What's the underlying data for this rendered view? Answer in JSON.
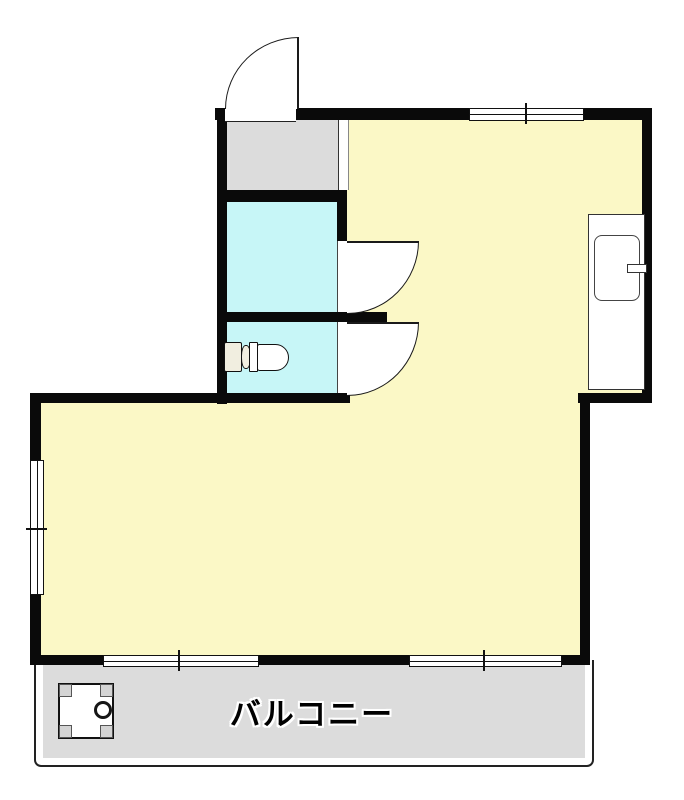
{
  "page": {
    "width": 684,
    "height": 800,
    "background": "#ffffff"
  },
  "colors": {
    "wall": "#0a0a0a",
    "room_yellow": "#fbf8c6",
    "wet_cyan": "#c7f6f7",
    "entry_gray": "#dcdcdc",
    "balcony_gray": "#dcdcdc",
    "tank_ivory": "#f1eee0"
  },
  "balcony": {
    "label": "バルコニー"
  },
  "legend": {
    "areas": [
      "kitchen-dining",
      "living-room",
      "entry",
      "bathroom",
      "toilet-room",
      "balcony"
    ],
    "fixtures": [
      "entrance-door-swing",
      "bathroom-door-swing",
      "toilet-door-swing",
      "kitchen-counter",
      "kitchen-sink",
      "kitchen-faucet",
      "toilet",
      "washing-machine-pan",
      "pan-drain"
    ],
    "windows": [
      "window-top",
      "window-left",
      "window-bottom-left",
      "window-bottom-right"
    ]
  }
}
